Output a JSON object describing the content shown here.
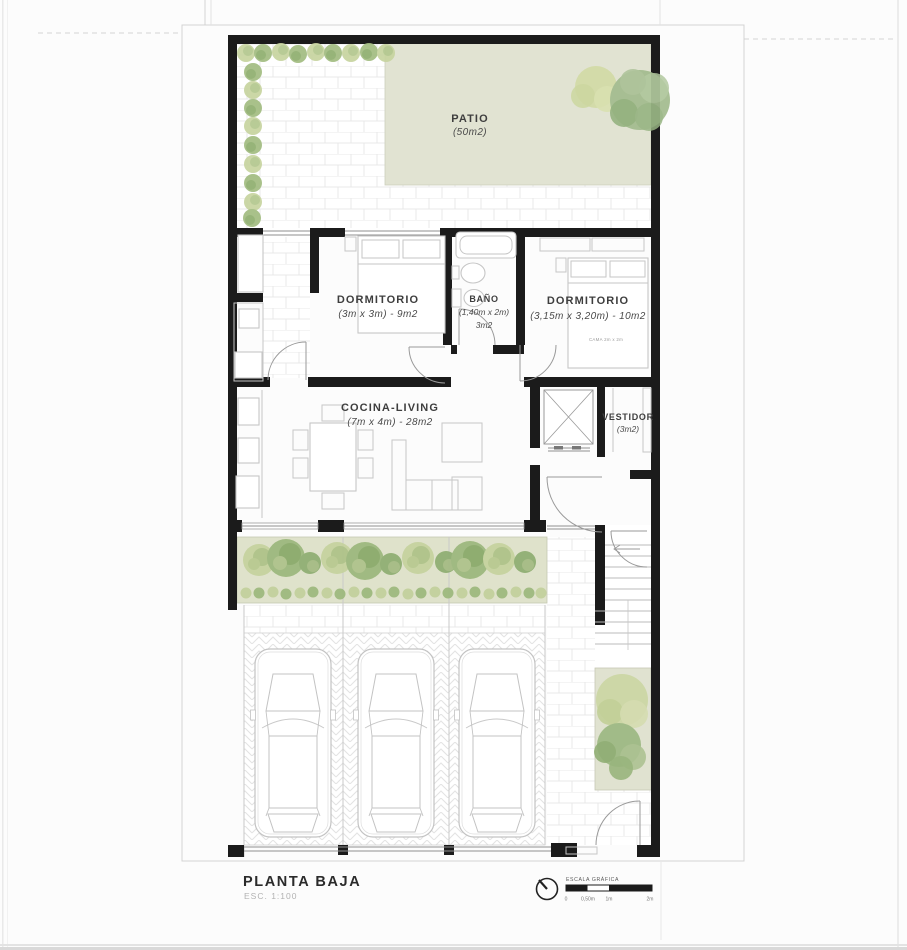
{
  "page": {
    "title": "PLANTA BAJA",
    "scale_label": "ESC. 1:100"
  },
  "rooms": {
    "patio": {
      "name": "PATIO",
      "dims": "(50m2)"
    },
    "dormitorio1": {
      "name": "DORMITORIO",
      "dims": "(3m x 3m) - 9m2"
    },
    "bano": {
      "name": "BAÑO",
      "dims": "(1,40m x 2m)",
      "area": "3m2"
    },
    "dormitorio2": {
      "name": "DORMITORIO",
      "dims": "(3,15m x 3,20m) - 10m2",
      "bed_label": "CAMA 2m x 2m"
    },
    "cocina": {
      "name": "COCINA-LIVING",
      "dims": "(7m x 4m) - 28m2"
    },
    "vestidor": {
      "name": "VESTIDOR",
      "dims": "(3m2)"
    }
  },
  "scale_bar": {
    "title": "ESCALA GRÁFICA",
    "ticks": [
      "0",
      "0,50m",
      "1m",
      "2m"
    ]
  },
  "colors": {
    "wall": "#1b1b1b",
    "patio_green": "#e1e3d2",
    "garden_green": "#dfe2cb",
    "bush_light": "#c7d4a0",
    "bush_dark": "#a3bd82"
  }
}
